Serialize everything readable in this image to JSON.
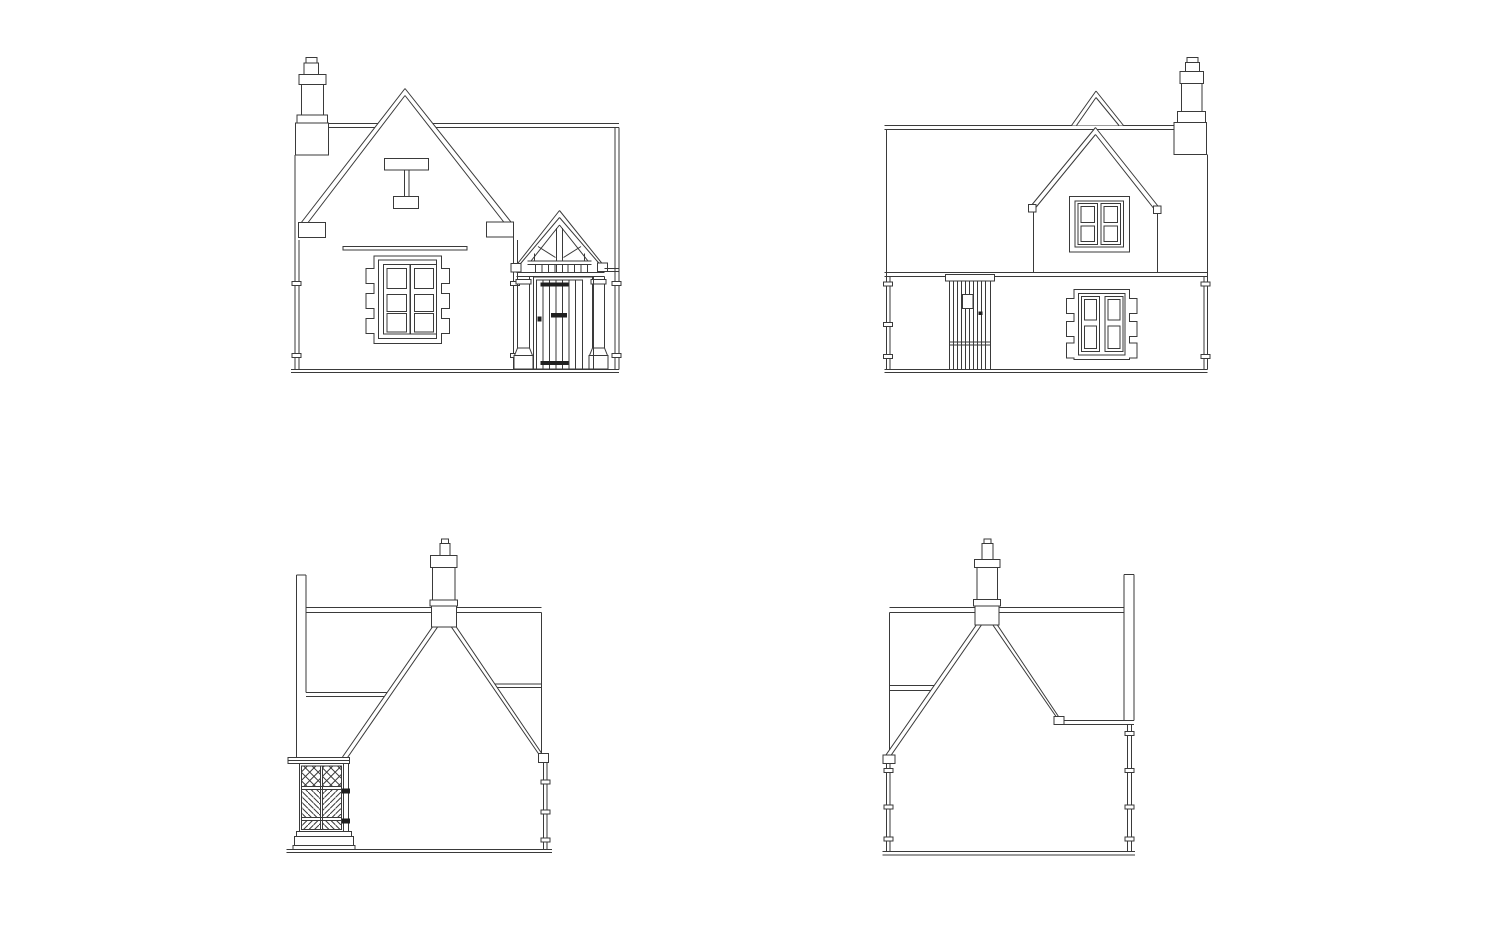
{
  "page": {
    "background_color": "#ffffff",
    "line_color": "#3a3a3a",
    "ironmongery_color": "#1f1f1f",
    "sheet_label": "Cottage elevation drawings"
  },
  "views": {
    "front_elevation": {
      "name": "front-elevation",
      "position": "top-left",
      "features": [
        "chimney-stack-with-pot",
        "main-gable-with-kneelers",
        "datestone-plaque",
        "string-course",
        "stone-mullioned-window-with-quoins",
        "gabled-timber-porch",
        "boarded-door-with-strap-hinges",
        "downpipes-with-brackets",
        "ground-line"
      ]
    },
    "rear_elevation": {
      "name": "rear-elevation",
      "position": "top-right",
      "features": [
        "chimney-stack-with-pot",
        "rear-cross-gable",
        "front-gable-peak-beyond",
        "first-floor-casement-window",
        "boarded-back-door-with-vision-panel",
        "quoined-casement-window",
        "eaves-band",
        "downpipes-with-brackets",
        "ground-line"
      ]
    },
    "side_elevation_left": {
      "name": "side-elevation-with-porch",
      "position": "bottom-left",
      "features": [
        "chimney-stack-with-pot",
        "gable-end-roof",
        "ridge-line",
        "eaves-lines",
        "front-wall-coping-edge",
        "porch-side-lattice-panel",
        "trellis-cross-hatch",
        "plinth",
        "downpipe-with-brackets",
        "ground-line"
      ]
    },
    "side_elevation_right": {
      "name": "side-elevation-plain",
      "position": "bottom-right",
      "features": [
        "chimney-stack-with-pot",
        "gable-end-roof",
        "ridge-line",
        "catslide-eaves",
        "rear-wall-coping-edge",
        "downpipes-with-brackets",
        "ground-line"
      ]
    }
  }
}
